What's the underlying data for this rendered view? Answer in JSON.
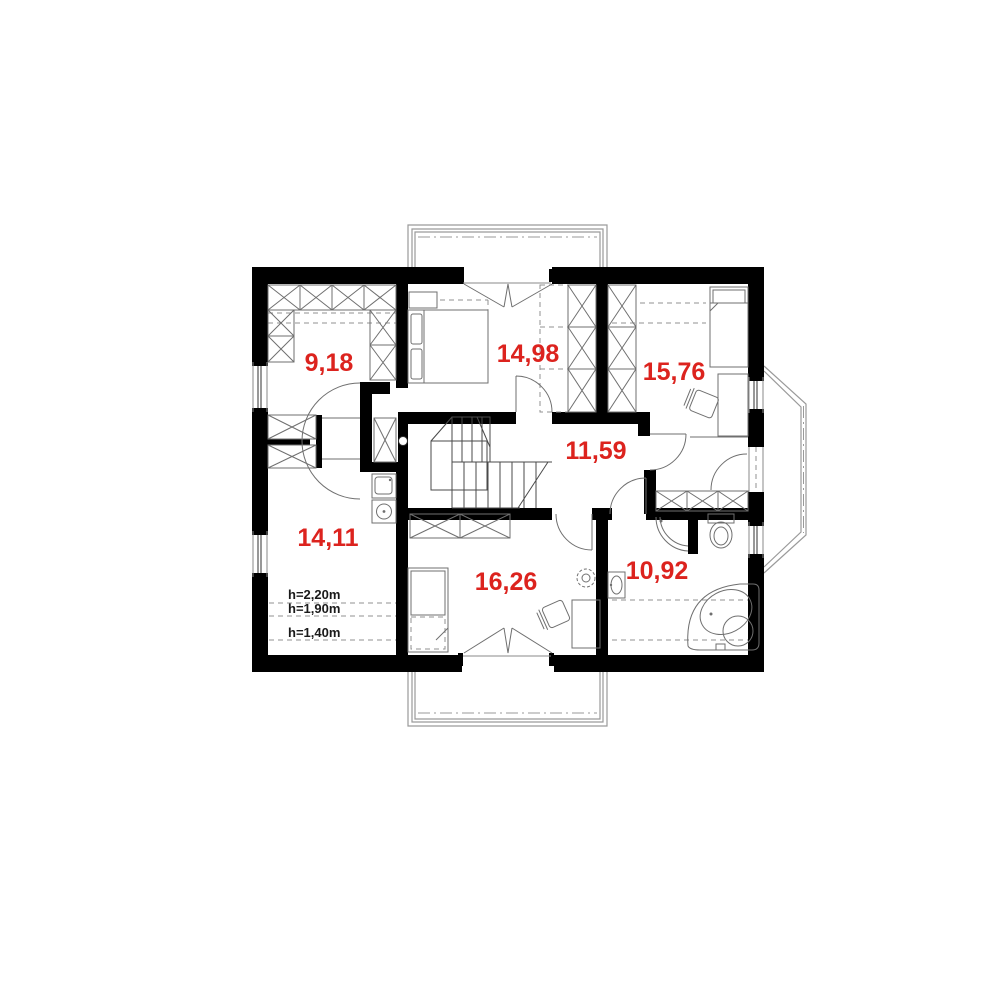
{
  "plan": {
    "type": "floor-plan",
    "rooms": [
      {
        "id": "room-top-left",
        "area": "9,18"
      },
      {
        "id": "room-top-center",
        "area": "14,98"
      },
      {
        "id": "room-top-right",
        "area": "15,76"
      },
      {
        "id": "hall-center",
        "area": "11,59"
      },
      {
        "id": "room-bottom-left",
        "area": "14,11"
      },
      {
        "id": "room-bottom-center",
        "area": "16,26"
      },
      {
        "id": "bathroom",
        "area": "10,92"
      }
    ],
    "height_annotations": [
      "h=2,20m",
      "h=1,90m",
      "h=1,40m"
    ],
    "colors": {
      "area_label": "#dc231e",
      "walls": "#000000",
      "furniture_lines": "#6f6f6f",
      "dashed_lines": "#909090"
    }
  }
}
